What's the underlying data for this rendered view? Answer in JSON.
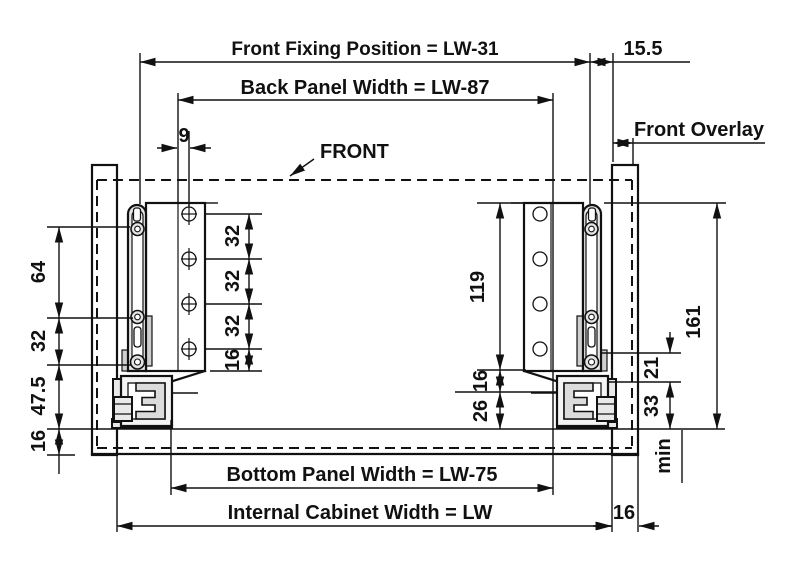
{
  "colors": {
    "ink": "#111111",
    "background": "#ffffff",
    "bracket_fill_light": "#e9e9e9",
    "bracket_fill_mid": "#dcdcdc"
  },
  "top": {
    "front_fixing_position": "Front Fixing Position = LW-31",
    "front_gap": "15.5",
    "back_panel_width": "Back Panel Width = LW-87",
    "hole_offset": "9",
    "front_label": "FRONT",
    "front_overlay": "Front Overlay"
  },
  "left_dims": {
    "top_pin": "64",
    "mid_pin": "32",
    "lower": "47.5",
    "bottom": "16"
  },
  "back_panel_holes": {
    "gap1": "32",
    "gap2": "32",
    "gap3": "32",
    "gap4": "16"
  },
  "right_bracket": {
    "plate_height": "119",
    "gap": "16",
    "base": "26"
  },
  "right_dims": {
    "pin_to_slide": "21",
    "slide_height": "33",
    "min_label": "min",
    "total_height": "161"
  },
  "bottom": {
    "bottom_panel_width": "Bottom Panel Width = LW-75",
    "internal_cabinet_width": "Internal Cabinet Width = LW",
    "wall_thickness": "16"
  }
}
